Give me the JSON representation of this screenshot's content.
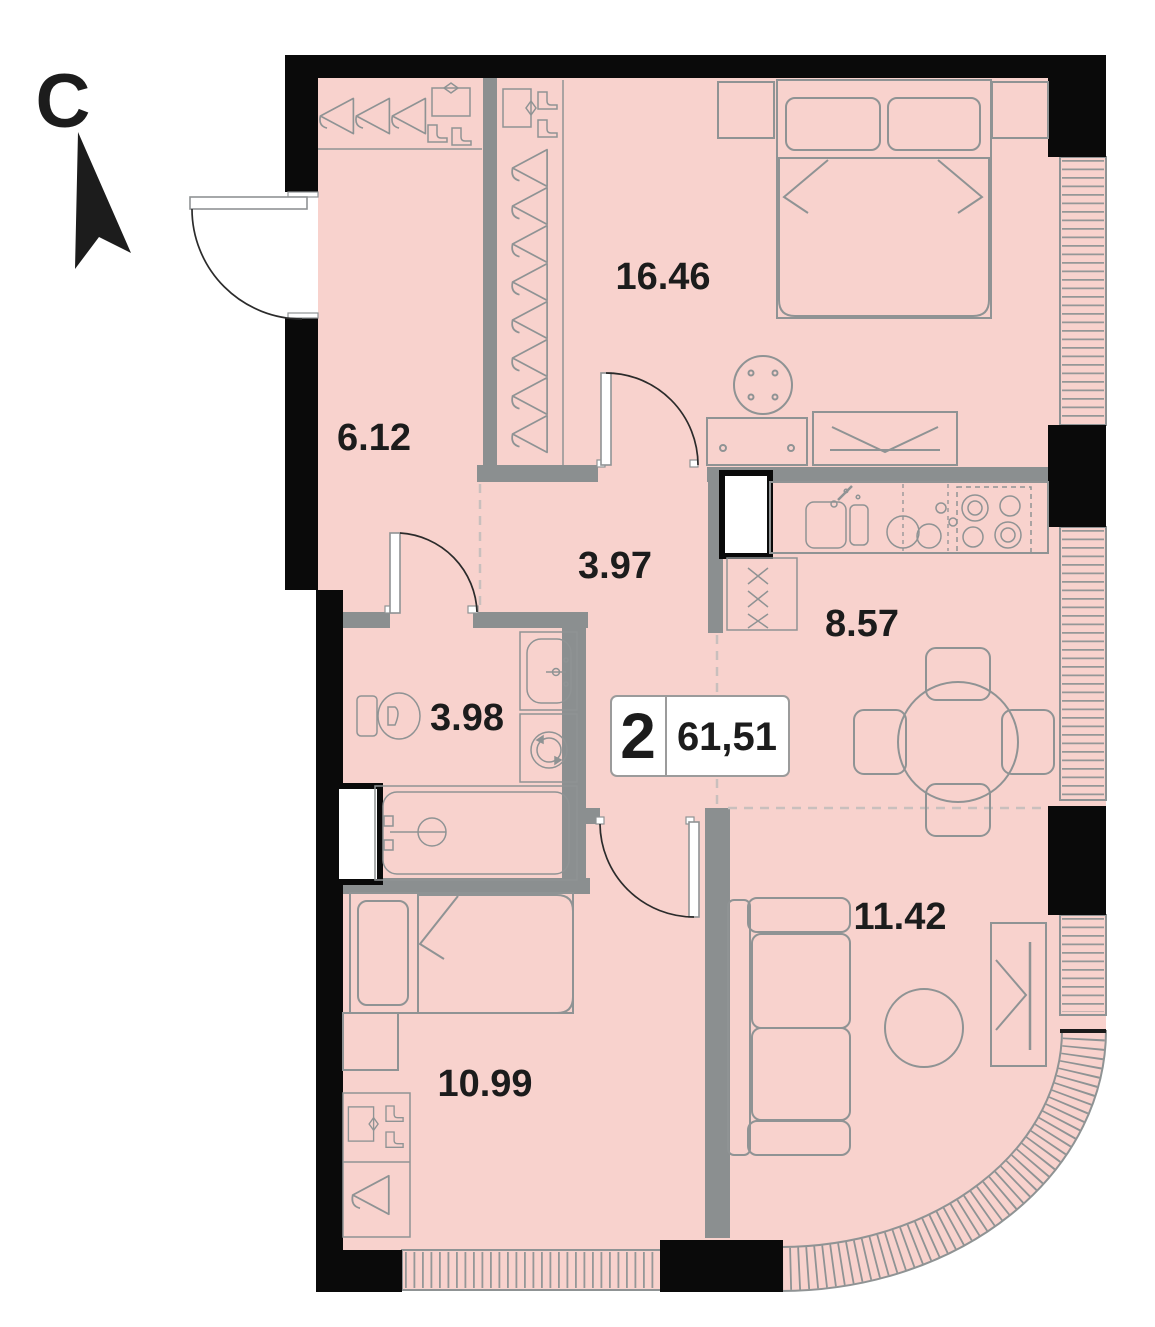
{
  "compass": {
    "letter": "C"
  },
  "badge": {
    "rooms_count": "2",
    "total_area": "61,51"
  },
  "rooms": [
    {
      "name": "bedroom-main",
      "area": "16.46"
    },
    {
      "name": "hallway",
      "area": "6.12"
    },
    {
      "name": "corridor",
      "area": "3.97"
    },
    {
      "name": "kitchen",
      "area": "8.57"
    },
    {
      "name": "bathroom",
      "area": "3.98"
    },
    {
      "name": "living-room",
      "area": "11.42"
    },
    {
      "name": "bedroom-second",
      "area": "10.99"
    }
  ],
  "icons": [
    "north-arrow",
    "coat-hanger",
    "shoe-box",
    "boots",
    "double-bed",
    "single-bed",
    "pillow",
    "round-stool",
    "dresser",
    "tv-cabinet",
    "kitchen-sink",
    "dishes",
    "stove",
    "dining-table",
    "chair",
    "sofa",
    "coffee-table",
    "tv-stand",
    "toilet",
    "washbasin",
    "washing-machine",
    "bathtub",
    "wardrobe",
    "window-radiator",
    "duct-shaft"
  ],
  "colors": {
    "floor": "#f8d2cd",
    "wall": "#8b8f90",
    "black": "#0a0a0a",
    "line": "#8f9394",
    "dash": "#c9bfbd",
    "arc": "#2b2b2b",
    "text": "#1c1c1c",
    "badge": "#9b9b9b"
  }
}
